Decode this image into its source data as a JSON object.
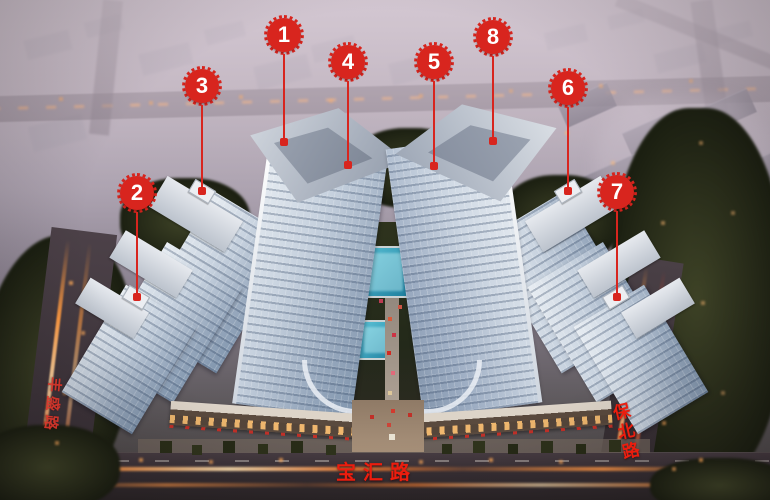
{
  "markers": [
    {
      "label": "1"
    },
    {
      "label": "2"
    },
    {
      "label": "3"
    },
    {
      "label": "4"
    },
    {
      "label": "5"
    },
    {
      "label": "6"
    },
    {
      "label": "7"
    },
    {
      "label": "8"
    }
  ],
  "roads": {
    "left_vertical": "丰盛路",
    "bottom": "宝汇路",
    "right_vertical": "保北路"
  },
  "colors": {
    "marker_red": "#d8251e",
    "road_label_red": "#ec1d0e"
  }
}
